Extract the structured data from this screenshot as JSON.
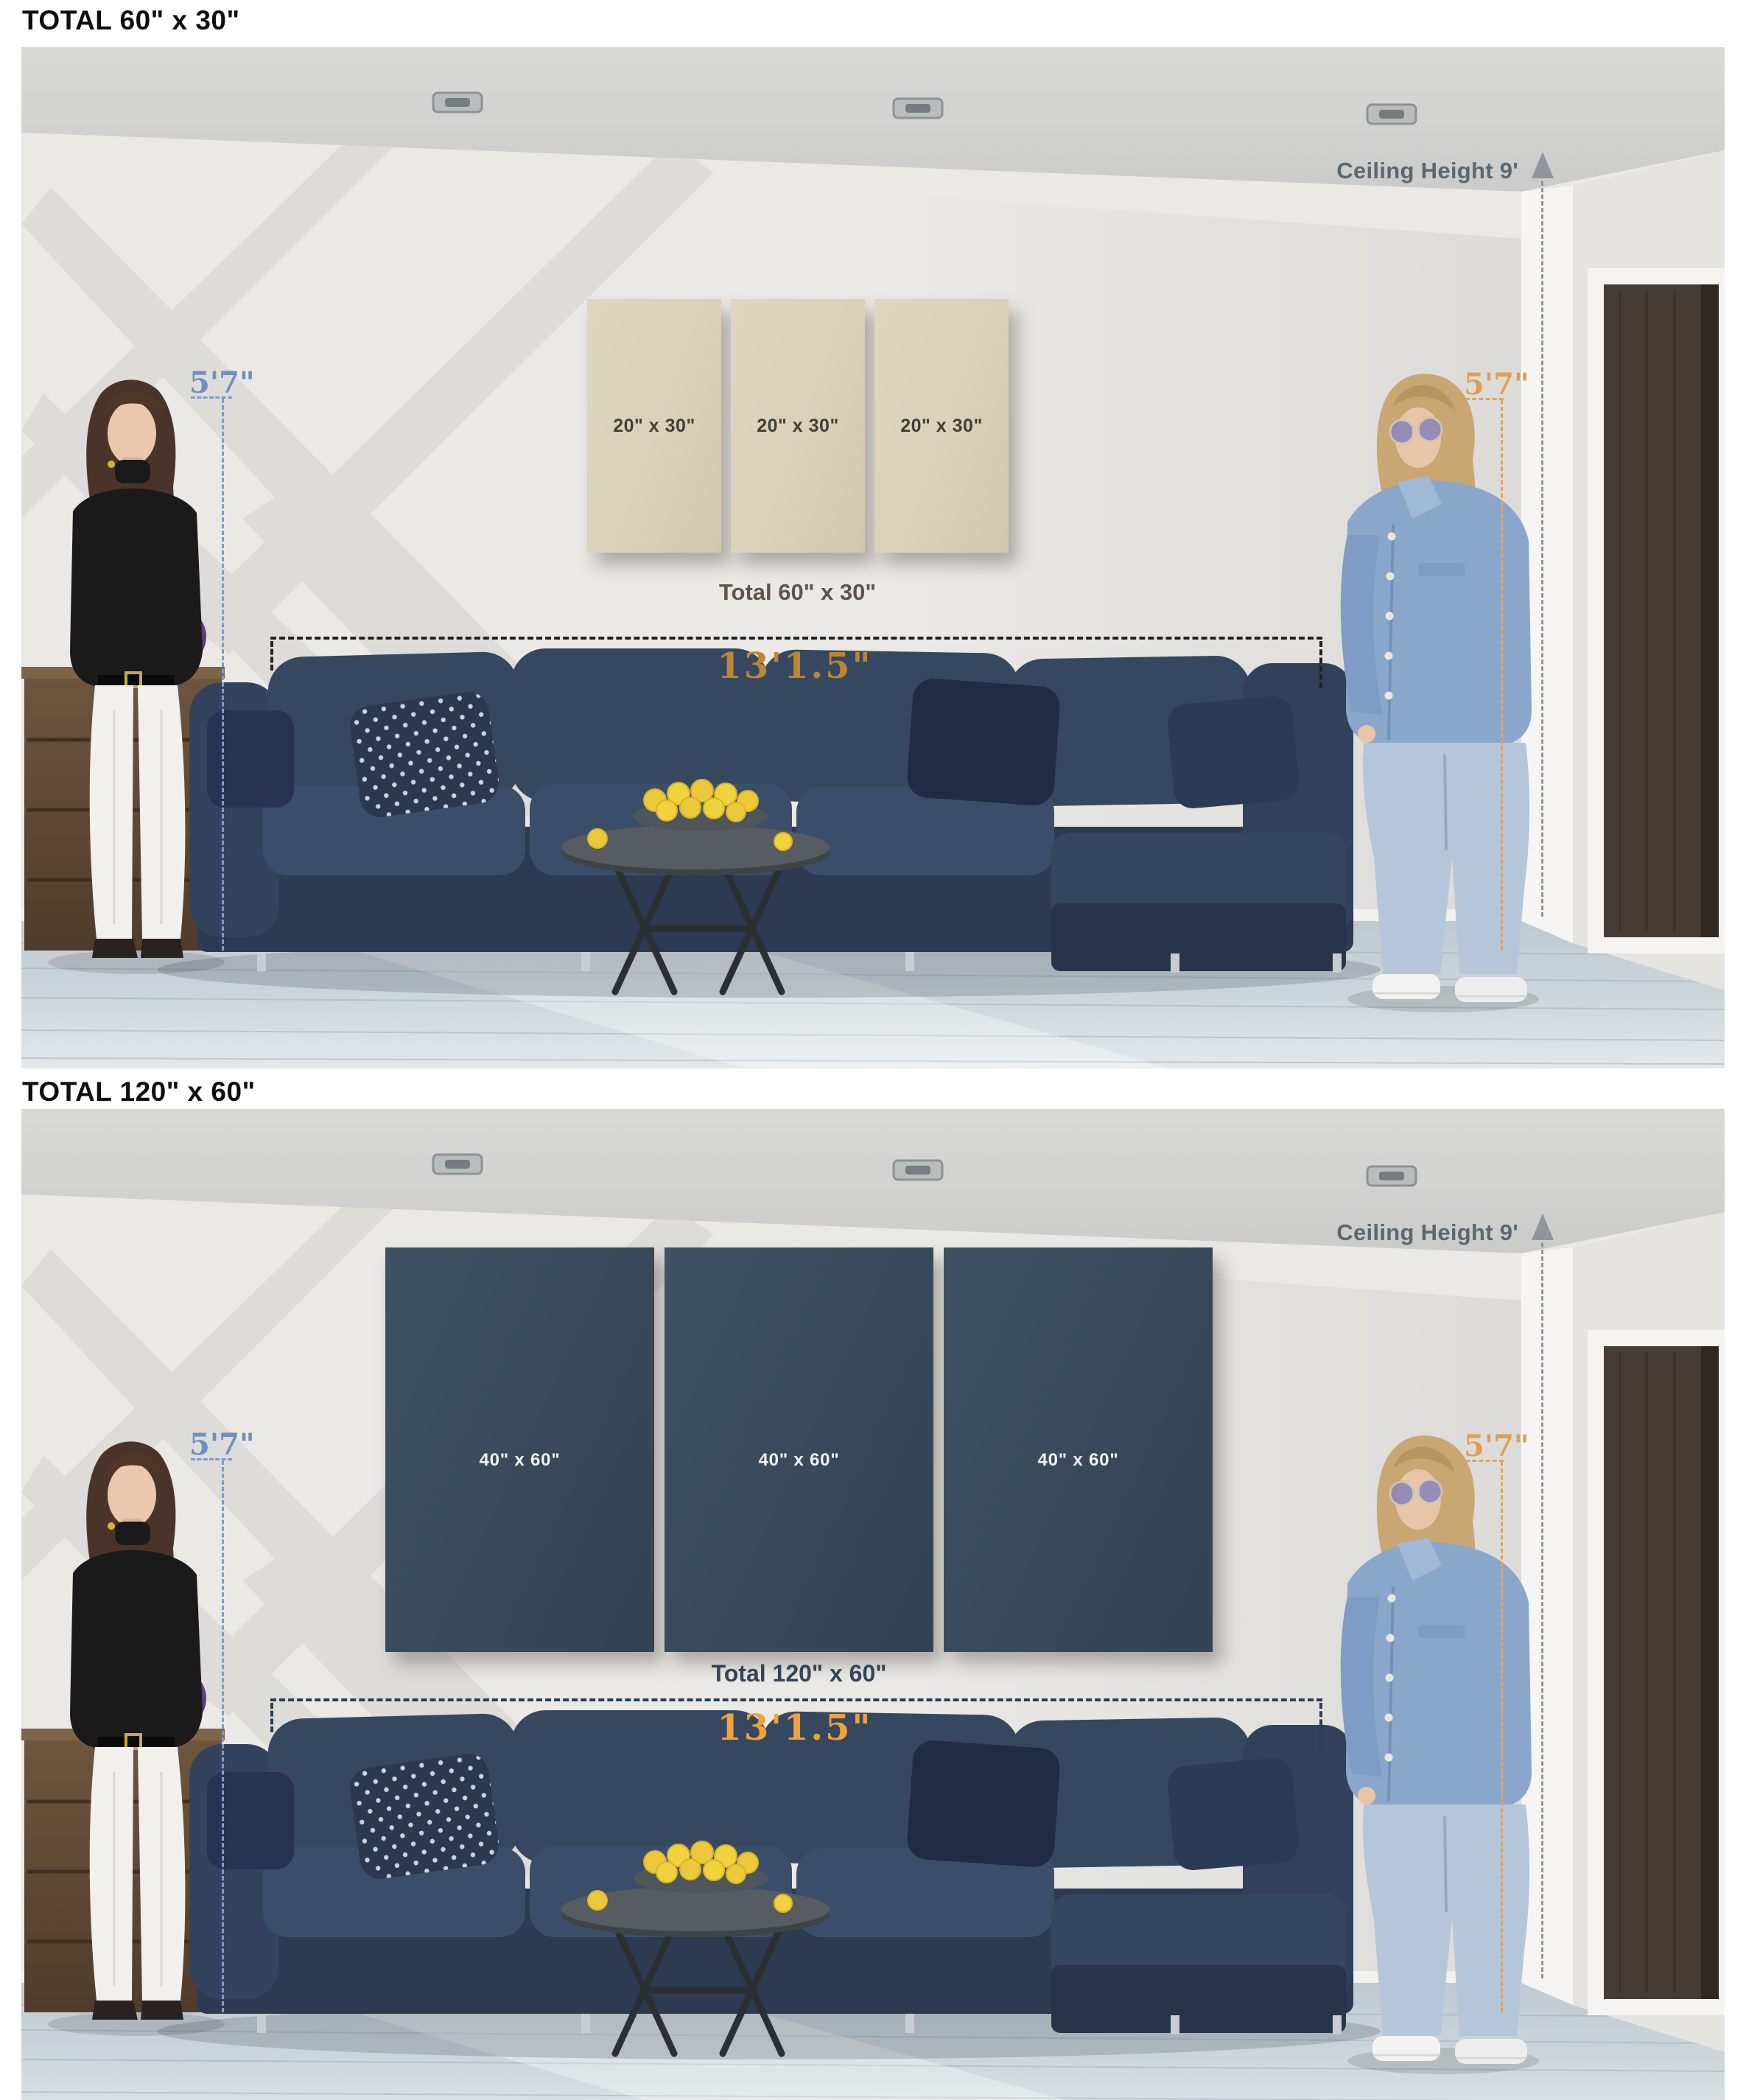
{
  "scene1": {
    "title": "TOTAL 60\" x 30\"",
    "panel_labels": [
      "20\" x 30\"",
      "20\" x 30\"",
      "20\" x 30\""
    ],
    "caption": "Total 60\" x 30\"",
    "width_label": "13'1.5\"",
    "left_person_height": "5'7\"",
    "right_person_height": "5'7\"",
    "ceiling_label": "Ceiling Height 9'"
  },
  "scene2": {
    "title": "TOTAL 120\" x 60\"",
    "panel_labels": [
      "40\" x 60\"",
      "40\" x 60\"",
      "40\" x 60\""
    ],
    "caption": "Total 120\" x 60\"",
    "width_label": "13'1.5\"",
    "left_person_height": "5'7\"",
    "right_person_height": "5'7\"",
    "ceiling_label": "Ceiling Height 9'"
  },
  "colors": {
    "page_background": "#ffffff",
    "height_label_left": "#6f8fbe",
    "height_label_right": "#de9f55",
    "ceiling_label": "#5a6872",
    "width_label_scene1": "#bf8434",
    "width_label_scene2": "#f0a23d",
    "canvas_beige": "#d9d2b9",
    "canvas_navy": "#37495a",
    "caption_scene1": "#5b554d",
    "caption_scene2": "#334456",
    "sofa": "#33435e",
    "door": "#463c36",
    "wall": "#ebe9e6",
    "floor": "#c9d2d8"
  }
}
